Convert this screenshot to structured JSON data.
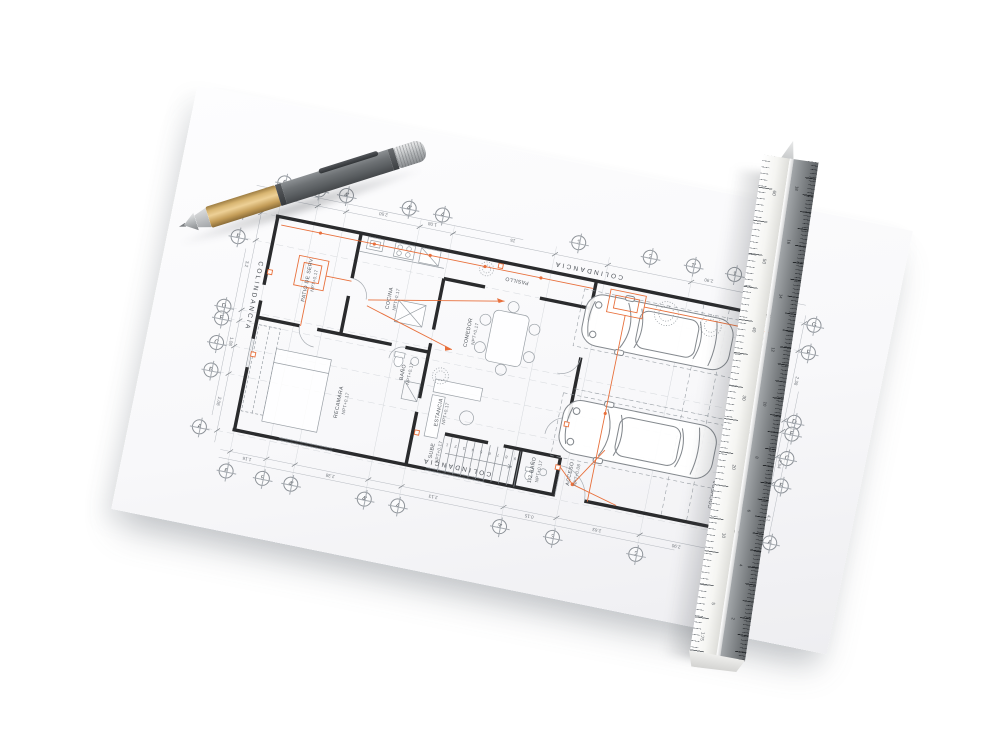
{
  "colors": {
    "paper": "#f8f8fa",
    "wall_line": "#2a2b2d",
    "thin_line": "#9aa0a6",
    "accent_orange": "#e8703c",
    "pen_grip_gold": "#d9b672",
    "pen_barrel_gray": "#6e7275",
    "ruler_light_face": "#f5f5f2",
    "ruler_dark_face": "#84888b"
  },
  "plan": {
    "colindancia_top": "COLINDANCIA",
    "colindancia_bottom": "COLINDANCIA",
    "colindancia_left": "COLINDANCIA",
    "rooms": [
      {
        "name": "PATIO DE SERV.",
        "level": "NPT+0.17"
      },
      {
        "name": "COCINA",
        "level": "NPT+0.17"
      },
      {
        "name": "PASILLO",
        "level": ""
      },
      {
        "name": "COMEDOR",
        "level": "NPT+0.17"
      },
      {
        "name": "ESTANCIA",
        "level": "NPT+0.17"
      },
      {
        "name": "RECAMARA",
        "level": "NPT+0.17"
      },
      {
        "name": "BAÑO",
        "level": "NPT+0.17"
      },
      {
        "name": "SUBE",
        "level": "NPT+0.17"
      },
      {
        "name": "1/2 BAÑO",
        "level": "NPT+0.17"
      },
      {
        "name": "ACCESO",
        "level": "NPT+0.08"
      },
      {
        "name": "COCHERA",
        "level": "NPT+0.08"
      }
    ],
    "grid_top": [
      "6",
      "5",
      "4'",
      "4'",
      "4",
      "3",
      "2",
      "1'",
      "1"
    ],
    "grid_bottom": [
      "6",
      "5",
      "4'",
      "4'",
      "4",
      "3'",
      "3",
      "2",
      "1"
    ],
    "grid_left": [
      "G",
      "F",
      "D",
      "E",
      "C",
      "B",
      "A"
    ],
    "grid_right": [
      "G",
      "F",
      "D",
      "E",
      "C",
      "B",
      "A"
    ],
    "stairs": [
      "9",
      "8",
      "7",
      "6",
      "5",
      "4",
      "3",
      "2",
      "1"
    ],
    "dimensions_top": [
      "2.50",
      "1.08",
      "15",
      "2.90"
    ],
    "dimensions_bottom": [
      "1.16",
      "2.38",
      "2.13",
      "0.15",
      "2.63",
      "2.90"
    ],
    "dimensions_left": [
      "3.2",
      "1.08",
      "2.08"
    ],
    "dimensions_right": [
      "2.38",
      "2.54",
      "4.1"
    ]
  },
  "ruler": {
    "scale_label": "1:75",
    "light_face_numbers": [
      "60",
      "50",
      "40",
      "30",
      "20",
      "10",
      "5"
    ],
    "dark_face_numbers": [
      "18",
      "16",
      "14",
      "12",
      "10",
      "8",
      "6",
      "4",
      "2"
    ]
  }
}
